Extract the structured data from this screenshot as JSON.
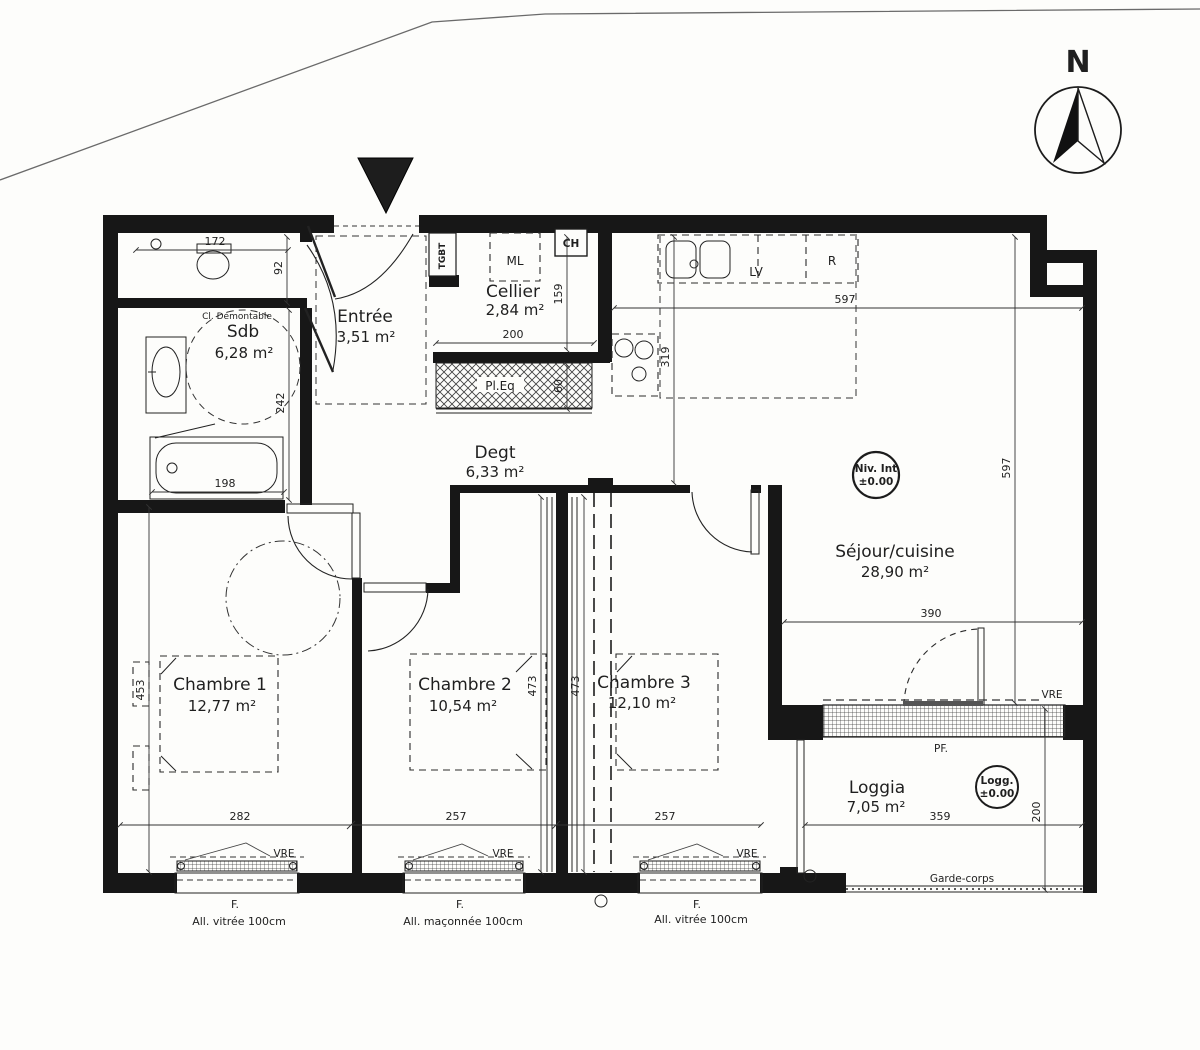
{
  "plan": {
    "compass": {
      "north": "N"
    },
    "rooms": {
      "sdb": {
        "name": "Sdb",
        "area": "6,28 m²"
      },
      "entree": {
        "name": "Entrée",
        "area": "3,51 m²"
      },
      "cellier": {
        "name": "Cellier",
        "area": "2,84 m²"
      },
      "degt": {
        "name": "Degt",
        "area": "6,33 m²"
      },
      "sejour": {
        "name": "Séjour/cuisine",
        "area": "28,90 m²"
      },
      "chambre1": {
        "name": "Chambre 1",
        "area": "12,77 m²"
      },
      "chambre2": {
        "name": "Chambre 2",
        "area": "10,54 m²"
      },
      "chambre3": {
        "name": "Chambre 3",
        "area": "12,10 m²"
      },
      "loggia": {
        "name": "Loggia",
        "area": "7,05 m²"
      }
    },
    "equipment": {
      "tgbt": "TGBT",
      "ml": "ML",
      "ch": "CH",
      "lv": "LV",
      "fridge": "R",
      "closet": "Pl.Eq",
      "partition": "Cl. Démontable"
    },
    "levels": {
      "niv_int": "Niv. Int",
      "niv_val": "±0.00",
      "logg": "Logg.",
      "logg_val": "±0.00"
    },
    "openings": {
      "pf": "PF.",
      "vre": "VRE",
      "garde_corps": "Garde-corps",
      "window": "F.",
      "all_vitree": "All. vitrée 100cm",
      "all_maconnee": "All. maçonnée 100cm"
    },
    "dims": {
      "v172": "172",
      "v92": "92",
      "v242": "242",
      "v198": "198",
      "v200": "200",
      "v159": "159",
      "v60": "60",
      "v319": "319",
      "v597": "597",
      "v390": "390",
      "v453": "453",
      "v282": "282",
      "v257": "257",
      "v473": "473",
      "v359": "359"
    }
  }
}
